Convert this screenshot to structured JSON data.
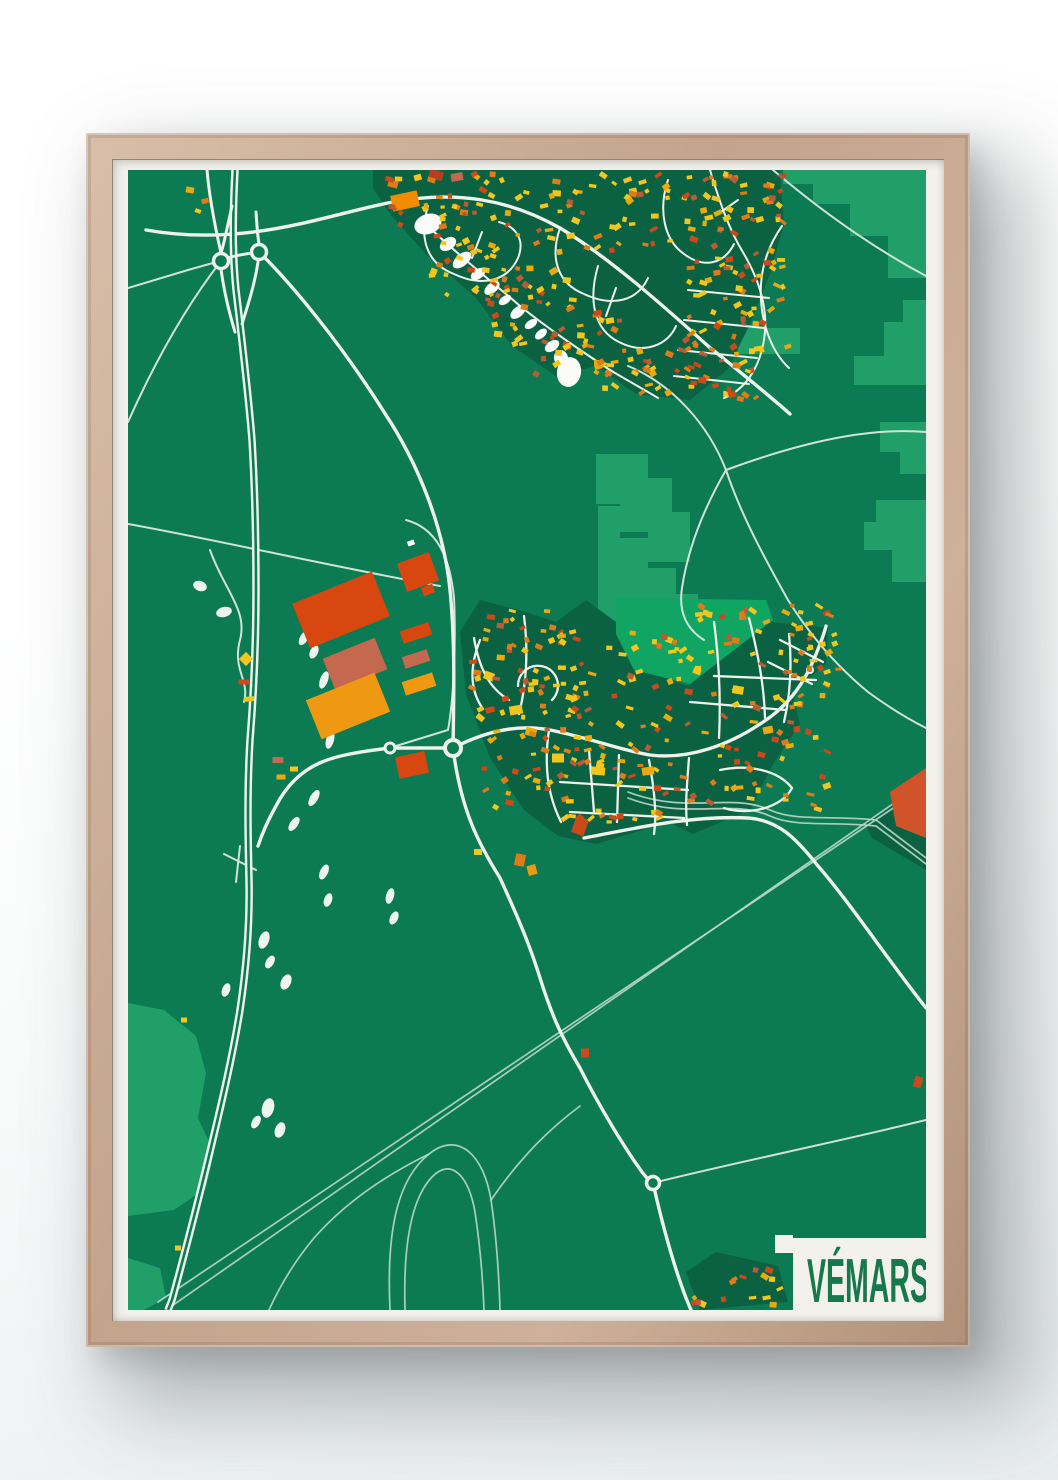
{
  "poster": {
    "title": "VÉMARS"
  },
  "colors": {
    "wall": "#ffffff",
    "frame_wood": "#c3a38c",
    "mat_paper": "#f2f1ec",
    "map_base": "#0c7a53",
    "field_green": "#209f68",
    "bright_green": "#10a562",
    "urban_dark": "#0b6243",
    "road_major": "#edf2ec",
    "road_thin": "#cfe3d8",
    "rail": "#b9d8c9",
    "water": "#fbfcfa",
    "title_green": "#17784b",
    "accent_orange": "#d8470f"
  },
  "map": {
    "width": 798,
    "height": 1140,
    "field_patches": [
      "M655,0 L798,0 L798,108 L760,108 L760,66 L722,66 L722,34 L685,34 L685,14 L655,14 Z",
      "M798,130 L798,215 L726,215 L726,186 L756,186 L756,152 L775,152 L775,130 Z",
      "M752,252 L798,252 L798,304 L772,304 L772,282 L752,282 Z",
      "M748,330 L798,330 L798,412 L764,412 L764,380 L736,380 L736,352 L748,352 Z",
      "M610,158 L672,158 L672,184 L610,184 Z",
      "M468,284 L520,284 L520,308 L544,308 L544,342 L562,342 L562,392 L520,392 L520,362 L492,362 L492,334 L468,334 Z",
      "M470,336 L492,336 L492,368 L520,368 L520,398 L548,398 L548,424 L570,424 L570,452 L540,468 L470,468 Z",
      "M0,833 L36,840 L68,866 L78,903 L70,948 L86,982 L78,1018 L46,1040 L0,1046 Z",
      "M0,1088 L32,1098 L38,1128 L16,1140 L0,1140 Z"
    ],
    "bright_patches": [
      "M488,428 L638,430 L645,450 L562,514 L506,500 L488,464 Z"
    ],
    "urban_patches": [
      "M245,0 L652,0 L656,54 L642,104 L622,154 L600,199 L562,230 L508,224 L468,196 L428,206 L384,176 L348,128 L298,84 L262,44 L245,18 Z",
      "M332,462 L352,430 L398,442 L428,452 L458,430 L488,452 L504,496 L560,516 L642,452 L700,458 L698,494 L664,522 L672,554 L645,594 L622,640 L565,664 L540,652 L508,662 L468,674 L430,666 L396,640 L362,588 L338,524 Z",
      "M736,652 L798,614 L798,700 L744,668 Z",
      "M558,1102 L588,1082 L650,1096 L660,1132 L572,1140 Z"
    ],
    "rail_lines": [
      "M38,1140 L805,606",
      "M30,1132 L798,616",
      "M500,622 C560,645 602,622 642,640 C668,652 706,645 748,650 L798,688",
      "M500,628 C560,651 602,628 642,646 C668,658 706,651 748,656 L798,694",
      "M262,1140 C258,1056 271,1008 301,984 C331,960 356,986 363,1030 C369,1070 371,1108 372,1140",
      "M277,1140 C275,1072 284,1028 304,1007 C323,987 341,1006 347,1042 C353,1082 355,1112 356,1140",
      "M301,984 C256,1006 216,1034 186,1068 C166,1092 151,1118 141,1140",
      "M363,1030 C392,988 420,960 452,936"
    ],
    "thin_roads": [
      "M0,118 L60,100 L92,91",
      "M93,91 C55,140 25,196 0,252",
      "M0,354 C90,370 200,396 312,416",
      "M500,196 C544,214 580,254 598,300 C614,348 640,394 660,430 C680,462 706,494 740,522 C766,541 786,552 798,558",
      "M598,300 C690,266 752,258 798,262",
      "M598,300 C576,338 560,378 554,418 C550,444 560,460 576,470",
      "M645,0 C692,40 742,76 798,106",
      "M525,1013 C600,994 700,974 798,950",
      "M82,380 C96,420 120,440 112,470 C104,500 122,510 116,532",
      "M96,684 L128,700",
      "M112,676 L108,712",
      "M278,350 C308,358 322,386 326,428 C328,468 326,528 320,560 L268,576"
    ],
    "medium_roads": [
      "M18,60 C120,78 200,44 265,32 C330,20 382,30 432,58 C482,88 540,140 580,176 C612,202 642,226 662,244",
      "M131,82 C162,112 212,172 256,242 C292,296 316,360 322,420 C327,470 326,520 325,578",
      "M325,578 C333,642 352,676 372,708 C394,756 404,782 412,808 C424,846 434,868 452,898 C472,938 498,980 514,1002 C520,1010 523,1012 525,1013 C540,1080 555,1122 563,1140",
      "M262,578 L325,578",
      "M262,578 C228,582 208,586 194,592 C174,600 158,616 148,636 C140,650 134,664 130,676",
      "M325,578 C360,560 392,554 422,560 C462,568 492,580 522,585 C562,590 602,574 632,554 C658,538 672,518 682,498 C690,480 696,464 698,456",
      "M456,668 C500,660 560,645 620,648 C650,650 668,668 690,696 C720,730 760,790 798,838"
    ],
    "ramps": [
      "M104,36 C99,58 96,74 93,83",
      "M93,99 C96,122 101,142 107,162",
      "M130,92 C127,112 121,132 114,154",
      "M128,42 C129,58 130,68 131,74",
      "M93,91 C105,85 118,84 131,82",
      "M93,83 C86,52 81,24 79,0"
    ],
    "highway": "M107,0 C105,40 104,80 108,120 C114,170 120,220 124,270 C127,320 128,370 128,420 C128,470 126,520 122,570 C119,620 120,668 121,710 C122,758 118,800 112,840 C104,890 92,940 80,990 C68,1040 56,1086 44,1130 L40,1140",
    "town_streets": [
      "M346,468 C351,498 361,518 381,530",
      "M390,516 a20,20 0 1 1 34,14",
      "M396,446 C400,478 399,512 391,544",
      "M421,560 C416,594 419,624 433,652",
      "M461,580 L466,642",
      "M491,585 L489,652",
      "M521,590 C526,618 529,642 526,664",
      "M561,588 C559,614 557,634 559,655",
      "M586,452 C591,490 593,528 591,568",
      "M621,448 C629,480 636,512 637,548",
      "M661,464 C664,494 663,522 656,552",
      "M432,612 L560,620",
      "M442,642 L556,648",
      "M586,506 L688,510",
      "M562,532 L658,540",
      "M592,600 C620,594 650,600 664,618 C654,638 620,646 596,638",
      "M352,470 C341,498 343,520 353,536",
      "M652,470 L695,492",
      "M640,492 L684,514"
    ],
    "residential_streets": [
      "M300,36 C290,70 300,94 326,104 C356,118 380,110 390,88 C398,68 386,56 371,52",
      "M432,58 C421,90 431,114 456,124 C486,138 510,130 520,108",
      "M470,96 C460,130 466,160 491,172 C516,185 540,175 548,156",
      "M540,10 C530,40 536,70 556,84 C576,99 596,94 606,74",
      "M582,0 C591,30 601,60 616,84 C631,110 641,140 636,170 C631,200 616,220 596,228",
      "M654,56 C640,76 631,100 633,130 C635,160 646,184 661,198",
      "M560,120 L641,128",
      "M556,150 L636,158",
      "M550,180 L629,188",
      "M546,206 L621,214",
      "M302,58 C330,85 362,110 392,136 C422,160 452,180 482,200 C502,212 517,220 530,228",
      "M354,62 L344,88",
      "M488,118 L478,146",
      "M610,30 L590,44"
    ],
    "roundabouts": [
      [
        93,
        91,
        7.5,
        3.5
      ],
      [
        131,
        82,
        7.5,
        3.5
      ],
      [
        262,
        578,
        5,
        3
      ],
      [
        325,
        578,
        8,
        4
      ],
      [
        525,
        1013,
        6.5,
        3.5
      ],
      [
        682,
        500,
        3,
        2
      ]
    ],
    "water": [
      [
        300,
        54,
        14,
        10,
        -20
      ],
      [
        320,
        74,
        9,
        6,
        -35
      ],
      [
        334,
        90,
        11,
        6,
        -40
      ],
      [
        350,
        104,
        8,
        5,
        -35
      ],
      [
        364,
        118,
        9,
        5,
        -40
      ],
      [
        377,
        130,
        7,
        4,
        -35
      ],
      [
        390,
        142,
        9,
        5,
        -40
      ],
      [
        403,
        154,
        7,
        4,
        -35
      ],
      [
        413,
        164,
        7,
        4,
        -40
      ],
      [
        424,
        176,
        8,
        5,
        -35
      ],
      [
        433,
        188,
        7,
        8,
        -15
      ],
      [
        441,
        202,
        12,
        15,
        10
      ]
    ],
    "white_bits": [
      [
        72,
        416,
        7,
        5,
        20
      ],
      [
        96,
        442,
        8,
        5,
        -15
      ],
      [
        176,
        468,
        4,
        8,
        30
      ],
      [
        186,
        482,
        4,
        7,
        25
      ],
      [
        196,
        510,
        4,
        9,
        20
      ],
      [
        202,
        570,
        4,
        9,
        15
      ],
      [
        186,
        628,
        4,
        9,
        30
      ],
      [
        166,
        654,
        4,
        8,
        35
      ],
      [
        196,
        702,
        4,
        8,
        25
      ],
      [
        200,
        730,
        4,
        7,
        20
      ],
      [
        262,
        726,
        4,
        8,
        15
      ],
      [
        266,
        748,
        4,
        7,
        25
      ],
      [
        136,
        770,
        5,
        9,
        20
      ],
      [
        142,
        792,
        4,
        7,
        30
      ],
      [
        158,
        812,
        5,
        8,
        25
      ],
      [
        98,
        820,
        4,
        7,
        20
      ],
      [
        140,
        938,
        6,
        10,
        15
      ],
      [
        152,
        960,
        5,
        8,
        20
      ],
      [
        128,
        952,
        4,
        7,
        30
      ]
    ],
    "orange_quad": "M762,622 L798,598 L798,668 L768,656 Z",
    "warehouses": [
      [
        213,
        440,
        86,
        48,
        -22,
        "#d8470f"
      ],
      [
        227,
        494,
        56,
        34,
        -22,
        "#c4684f"
      ],
      [
        220,
        536,
        74,
        42,
        -22,
        "#ef9811"
      ],
      [
        290,
        402,
        34,
        30,
        -20,
        "#d8470f"
      ],
      [
        300,
        420,
        12,
        9,
        -20,
        "#d8470f"
      ],
      [
        288,
        463,
        30,
        13,
        -18,
        "#d8470f"
      ],
      [
        288,
        489,
        26,
        12,
        -18,
        "#c4684f"
      ],
      [
        291,
        514,
        32,
        14,
        -18,
        "#ef9811"
      ],
      [
        284,
        595,
        30,
        22,
        -12,
        "#d8470f"
      ]
    ],
    "single_buildings": [
      [
        62,
        20,
        8,
        6,
        10,
        "#e9a90f"
      ],
      [
        77,
        31,
        7,
        5,
        -15,
        "#e07b1a"
      ],
      [
        70,
        41,
        6,
        4,
        20,
        "#f3c61e"
      ],
      [
        277,
        31,
        27,
        16,
        -12,
        "#ef8c00"
      ],
      [
        308,
        5,
        14,
        9,
        15,
        "#b33f20"
      ],
      [
        329,
        7,
        12,
        8,
        -10,
        "#c4684f"
      ],
      [
        355,
        20,
        8,
        5,
        30,
        "#cc4a1a"
      ],
      [
        265,
        14,
        10,
        7,
        15,
        "#e07b1a"
      ],
      [
        118,
        489,
        10,
        10,
        45,
        "#f3c61e"
      ],
      [
        116,
        512,
        11,
        5,
        0,
        "#cc4a1a"
      ],
      [
        121,
        529,
        10,
        5,
        -5,
        "#f3c61e"
      ],
      [
        150,
        590,
        11,
        6,
        0,
        "#c4684f"
      ],
      [
        153,
        607,
        9,
        5,
        0,
        "#e9a90f"
      ],
      [
        166,
        599,
        8,
        5,
        0,
        "#f3c61e"
      ],
      [
        283,
        373,
        7,
        5,
        -20,
        "#ffffff"
      ],
      [
        452,
        656,
        13,
        17,
        20,
        "#cc4a1a"
      ],
      [
        392,
        690,
        10,
        12,
        10,
        "#e07b1a"
      ],
      [
        404,
        700,
        9,
        10,
        -15,
        "#ef9811"
      ],
      [
        350,
        682,
        8,
        6,
        0,
        "#f3c61e"
      ],
      [
        790,
        912,
        8,
        11,
        15,
        "#cc4a1a"
      ],
      [
        457,
        883,
        8,
        9,
        0,
        "#cc4a1a"
      ],
      [
        56,
        850,
        6,
        5,
        0,
        "#f3c61e"
      ],
      [
        50,
        1078,
        6,
        5,
        0,
        "#f3c61e"
      ],
      [
        388,
        540,
        13,
        9,
        -10,
        "#f3c61e"
      ],
      [
        403,
        562,
        11,
        8,
        15,
        "#e9a90f"
      ],
      [
        430,
        588,
        12,
        9,
        0,
        "#f3c61e"
      ],
      [
        470,
        601,
        14,
        8,
        5,
        "#f3c61e"
      ],
      [
        520,
        601,
        12,
        8,
        -8,
        "#e9a90f"
      ],
      [
        361,
        506,
        10,
        8,
        20,
        "#f3c61e"
      ],
      [
        610,
        520,
        11,
        8,
        10,
        "#f3c61e"
      ],
      [
        640,
        560,
        10,
        7,
        -12,
        "#e9a90f"
      ]
    ],
    "clusters": [
      [
        252,
        4,
        150,
        62,
        36,
        11
      ],
      [
        300,
        66,
        132,
        66,
        34,
        12
      ],
      [
        352,
        108,
        120,
        72,
        34,
        13
      ],
      [
        408,
        150,
        110,
        60,
        26,
        14
      ],
      [
        408,
        4,
        140,
        78,
        44,
        15
      ],
      [
        545,
        2,
        112,
        92,
        52,
        16
      ],
      [
        556,
        92,
        104,
        92,
        46,
        17
      ],
      [
        540,
        172,
        96,
        58,
        30,
        18
      ],
      [
        470,
        178,
        84,
        48,
        20,
        19
      ],
      [
        340,
        436,
        96,
        100,
        40,
        21
      ],
      [
        352,
        534,
        108,
        108,
        42,
        22
      ],
      [
        432,
        456,
        136,
        86,
        44,
        23
      ],
      [
        432,
        544,
        148,
        112,
        50,
        24
      ],
      [
        565,
        432,
        140,
        115,
        48,
        25
      ],
      [
        580,
        545,
        120,
        95,
        36,
        26
      ],
      [
        655,
        452,
        60,
        70,
        18,
        27
      ],
      [
        560,
        1086,
        96,
        50,
        16,
        31
      ]
    ],
    "building_palette": [
      [
        "#f3c61e",
        0.38
      ],
      [
        "#e9a90f",
        0.14
      ],
      [
        "#e07b1a",
        0.2
      ],
      [
        "#cc4a1a",
        0.16
      ],
      [
        "#b85c36",
        0.12
      ]
    ],
    "label_box": {
      "x": 665,
      "y": 1068,
      "w": 133,
      "h": 72,
      "step_x": 647,
      "step_y": 1065,
      "step_s": 18
    }
  }
}
